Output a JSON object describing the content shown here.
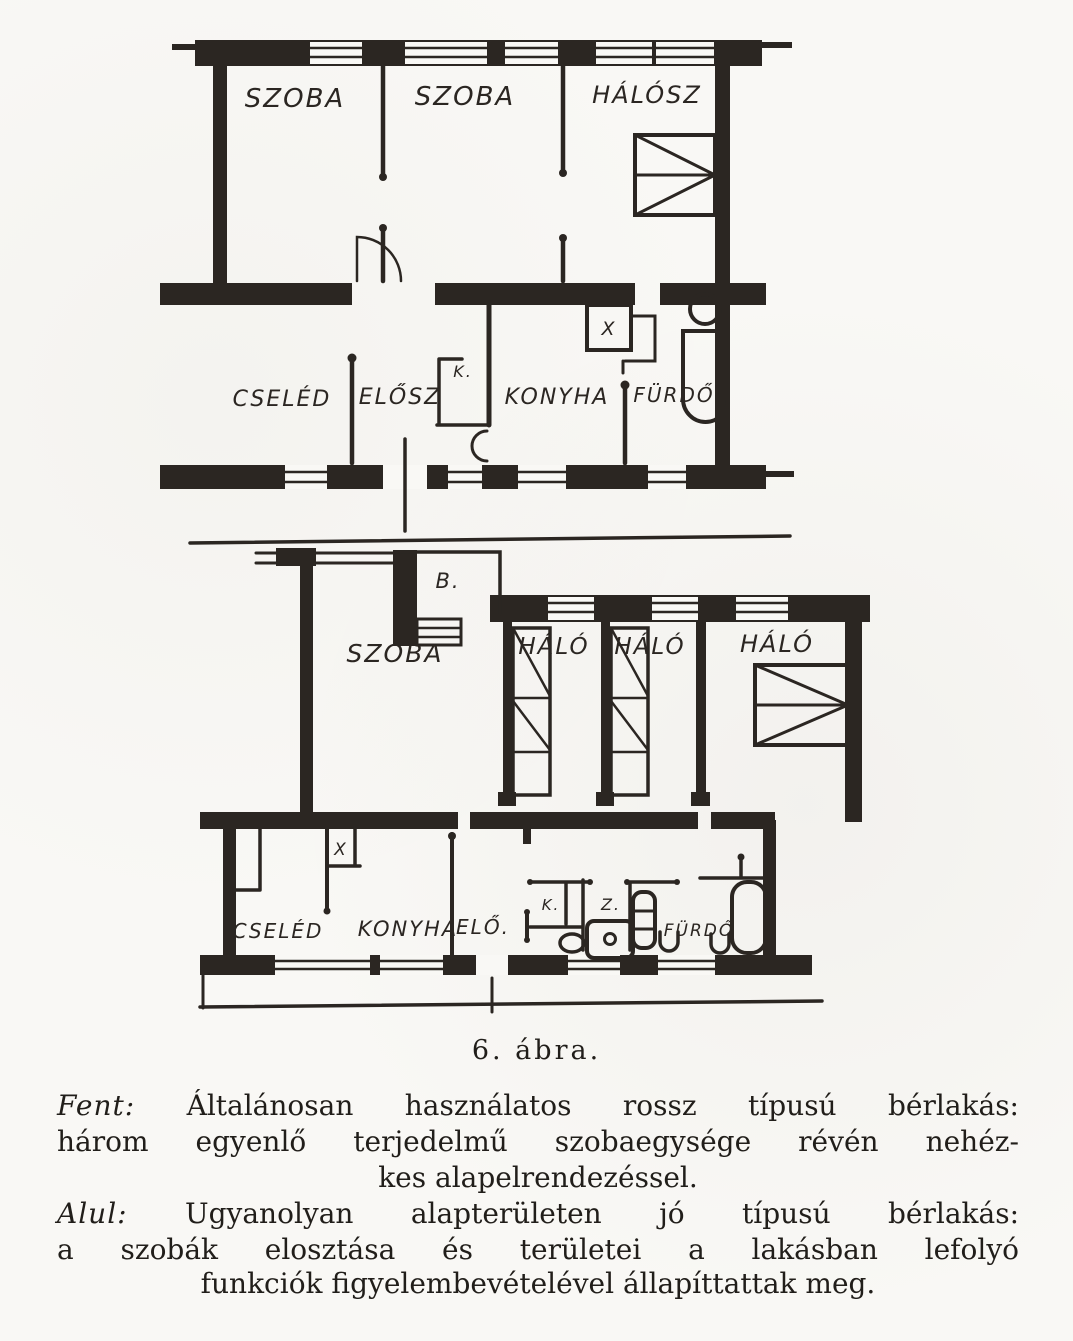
{
  "figure": {
    "number_label": "6. ábra.",
    "caption_fent": {
      "label": "Fent:",
      "line1": "Általánosan  használatos  rossz  típusú  bérlakás:",
      "line2": "három egyenlő terjedelmű szobaegysége révén nehéz-",
      "line3": "kes alapelrendezéssel."
    },
    "caption_alul": {
      "label": "Alul:",
      "line1": "Ugyanolyan  alapterületen  jó  típusú  bérlakás:",
      "line2": "a szobák elosztása és területei a lakásban lefolyó",
      "line3": "funkciók figyelembevételével állapíttattak meg."
    }
  },
  "plan_top": {
    "labels": {
      "szoba1": "SZOBA",
      "szoba2": "SZOBA",
      "halosz": "HÁLÓSZ",
      "cseled": "CSELÉD",
      "elosz": "ELŐSZ",
      "k_closet": "K.",
      "konyha": "KONYHA",
      "furdo": "FÜRDŐ",
      "wc": "X"
    }
  },
  "plan_bottom": {
    "labels": {
      "balcony": "B.",
      "szoba": "SZOBA",
      "halo1": "HÁLÓ",
      "halo2": "HÁLÓ",
      "halo3": "HÁLÓ",
      "cseled": "CSELÉD",
      "wc": "X",
      "konyha": "KONYHA",
      "elo": "ELŐ.",
      "k_closet": "K.",
      "z_closet": "Z.",
      "furdo": "FÜRDŐ"
    }
  },
  "colors": {
    "ink": "#2b2622",
    "paper": "#f9f8f5"
  }
}
